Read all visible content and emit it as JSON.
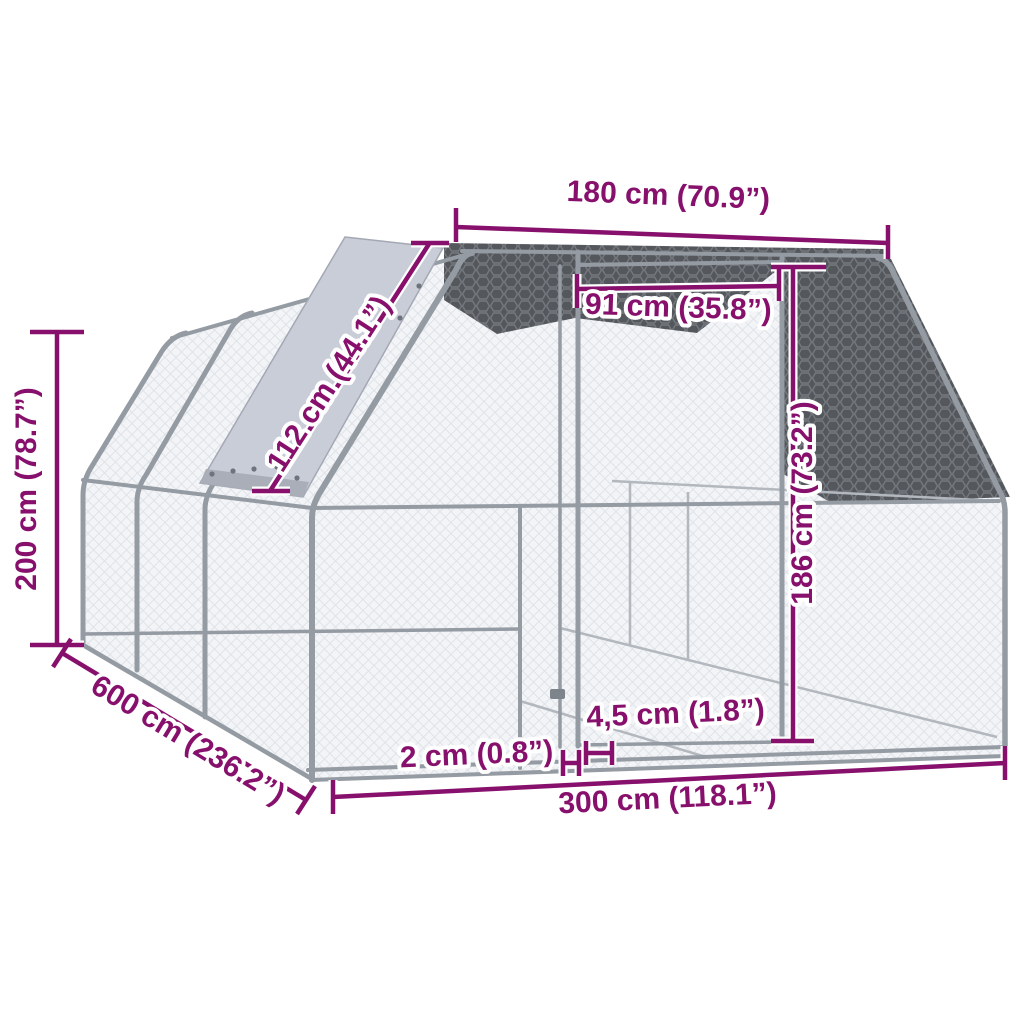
{
  "diagram": {
    "subject": "outdoor-chicken-cage-wireframe",
    "dimensions": [
      {
        "id": "top_width",
        "label": "180 cm (70.9”)"
      },
      {
        "id": "door_width",
        "label": "91 cm (35.8”)"
      },
      {
        "id": "roof_slant",
        "label": "112 cm (44.1”)"
      },
      {
        "id": "total_height",
        "label": "200 cm (78.7”)"
      },
      {
        "id": "depth",
        "label": "600 cm (236.2”)"
      },
      {
        "id": "door_height",
        "label": "186 cm (73.2”)"
      },
      {
        "id": "front_width",
        "label": "300 cm (118.1”)"
      },
      {
        "id": "frame_tube",
        "label": "2 cm (0.8”)"
      },
      {
        "id": "ground_gap",
        "label": "4,5 cm (1.8”)"
      }
    ],
    "colors": {
      "dimension": "#87106C",
      "halo": "#ffffff",
      "frame": "#959ba3",
      "frame_dark": "#7e848c",
      "frame_light": "#b3b8bf",
      "mesh_wall": "#f3f4f7",
      "mesh_line": "#e0e3e8",
      "roof_dark": "#54585d",
      "roof_hatch": "#75797f",
      "tarp": "#c9cdd8",
      "tarp_band": "#a9aeb9",
      "rivet": "#6e747e",
      "background": "#ffffff"
    }
  }
}
